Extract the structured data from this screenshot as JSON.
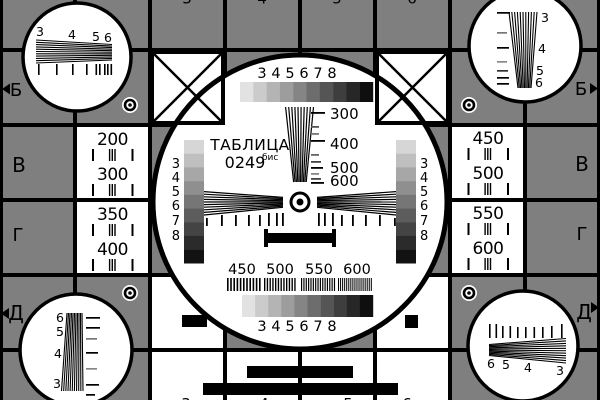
{
  "card": {
    "title": "ТАБЛИЦА",
    "number": "0249",
    "suffix": "бис"
  },
  "colors": {
    "background": "#7f7f7f",
    "ink": "#000000",
    "paper": "#ffffff"
  },
  "row_letters": [
    "Б",
    "В",
    "Г",
    "Д"
  ],
  "resolution_cells": {
    "left_upper": [
      "200",
      "300"
    ],
    "left_lower": [
      "350",
      "400"
    ],
    "right_upper": [
      "450",
      "500"
    ],
    "right_lower": [
      "550",
      "600"
    ]
  },
  "center_scale_labels": [
    "300",
    "400",
    "500",
    "600"
  ],
  "grayscale_labels": [
    "3",
    "4",
    "5",
    "6",
    "7",
    "8"
  ],
  "burst_labels": [
    "450",
    "500",
    "550",
    "600"
  ],
  "corner_wedge_labels": {
    "top_left": [
      "3",
      "4",
      "5",
      "6"
    ],
    "top_right": [
      "3",
      "4",
      "5",
      "6"
    ],
    "bottom_left": [
      "6",
      "5",
      "4",
      "3"
    ],
    "bottom_right": [
      "6",
      "5",
      "4",
      "3"
    ]
  },
  "edge_partial_digits": {
    "top": [
      "3",
      "4",
      "5",
      "6"
    ],
    "bottom": [
      "3",
      "4",
      "5",
      "6"
    ]
  },
  "grayscale_steps": [
    "#e2e2e2",
    "#cbcbcb",
    "#b4b4b4",
    "#9d9d9d",
    "#858585",
    "#6d6d6d",
    "#555555",
    "#3e3e3e",
    "#272727",
    "#0f0f0f"
  ],
  "strip_steps": [
    "#d6d6d6",
    "#bfbfbf",
    "#a7a7a7",
    "#8f8f8f",
    "#767676",
    "#5d5d5d",
    "#444444",
    "#2b2b2b",
    "#121212"
  ]
}
